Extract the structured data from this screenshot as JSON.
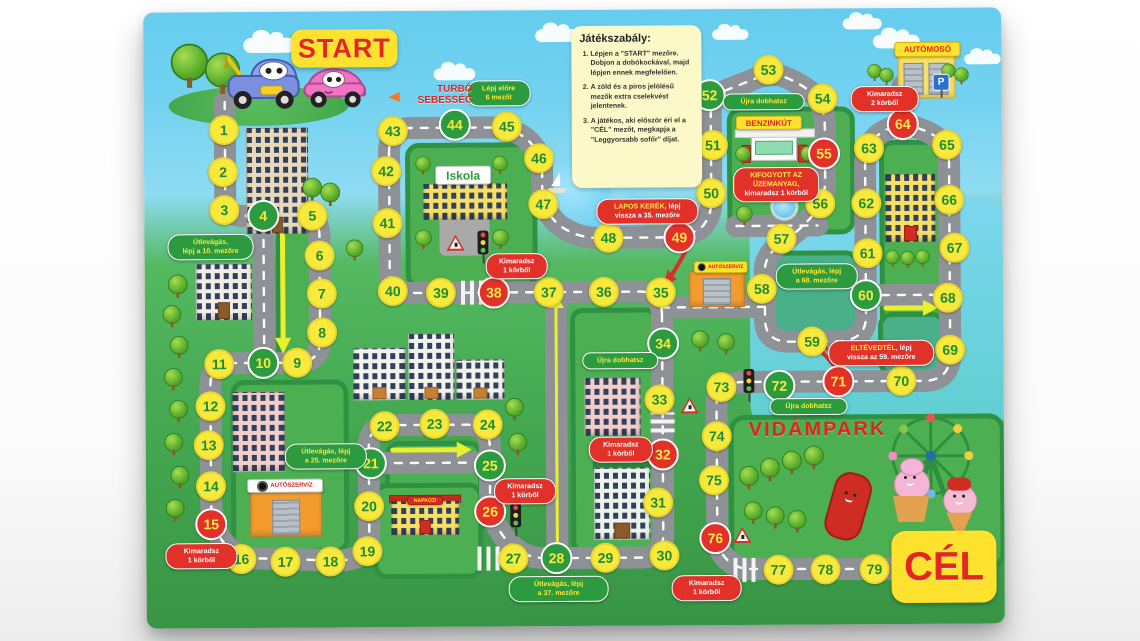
{
  "board": {
    "labels": {
      "start": "START",
      "goal": "CÉL",
      "turbo": "TURBÓ SEBESSÉG",
      "park": "VIDÁMPARK"
    },
    "rules": {
      "title": "Játékszabály:",
      "items": [
        "Lépjen a \"START\" mezőre. Dobjon a dobókockával, majd lépjen ennek megfelelően.",
        "A zöld és a piros jelölésű mezők extra cselekvést jelentenek.",
        "A játékos, aki először éri el a \"CÉL\" mezőt, megkapja a \"Leggyorsabb sofőr\" díjat."
      ]
    },
    "signs": {
      "school": "Iskola",
      "daycare": "NAPKÖZI",
      "car_service": "AUTÓSZERVIZ",
      "gas_station": "BENZINKÚT",
      "car_wash": "AUTÓMOSÓ",
      "parking": "P"
    },
    "colors": {
      "space_yellow": "#f8e93c",
      "space_green": "#2c9a3f",
      "space_red": "#e23128",
      "road": "#8e9196",
      "sign_yellow": "#ffe22e",
      "accent_red": "#e3261f"
    },
    "spaces": [
      [
        1,
        225,
        128,
        0
      ],
      [
        2,
        224,
        170,
        0
      ],
      [
        3,
        225,
        208,
        0
      ],
      [
        4,
        264,
        214,
        1
      ],
      [
        5,
        313,
        214,
        0
      ],
      [
        6,
        320,
        254,
        0
      ],
      [
        7,
        322,
        292,
        0
      ],
      [
        8,
        322,
        331,
        0
      ],
      [
        9,
        297,
        361,
        0
      ],
      [
        10,
        263,
        361,
        1
      ],
      [
        11,
        219,
        362,
        0
      ],
      [
        12,
        210,
        404,
        0
      ],
      [
        13,
        208,
        443,
        0
      ],
      [
        14,
        210,
        484,
        0
      ],
      [
        15,
        210,
        522,
        2
      ],
      [
        16,
        240,
        557,
        0
      ],
      [
        17,
        284,
        560,
        0
      ],
      [
        18,
        329,
        560,
        0
      ],
      [
        19,
        366,
        550,
        0
      ],
      [
        20,
        368,
        505,
        0
      ],
      [
        21,
        370,
        462,
        1
      ],
      [
        22,
        384,
        425,
        0
      ],
      [
        23,
        434,
        423,
        0
      ],
      [
        24,
        487,
        424,
        0
      ],
      [
        25,
        489,
        465,
        1
      ],
      [
        26,
        489,
        511,
        2
      ],
      [
        27,
        512,
        558,
        0
      ],
      [
        28,
        555,
        558,
        1
      ],
      [
        29,
        604,
        558,
        0
      ],
      [
        30,
        663,
        556,
        0
      ],
      [
        31,
        657,
        503,
        0
      ],
      [
        32,
        662,
        455,
        2
      ],
      [
        33,
        659,
        400,
        0
      ],
      [
        34,
        663,
        344,
        1
      ],
      [
        35,
        661,
        293,
        0
      ],
      [
        36,
        604,
        292,
        0
      ],
      [
        37,
        549,
        292,
        0
      ],
      [
        38,
        494,
        292,
        2
      ],
      [
        39,
        441,
        292,
        0
      ],
      [
        40,
        393,
        290,
        0
      ],
      [
        41,
        388,
        222,
        0
      ],
      [
        42,
        387,
        170,
        0
      ],
      [
        43,
        394,
        130,
        0
      ],
      [
        44,
        456,
        124,
        1
      ],
      [
        45,
        508,
        126,
        0
      ],
      [
        46,
        540,
        158,
        0
      ],
      [
        47,
        544,
        204,
        0
      ],
      [
        48,
        609,
        238,
        0
      ],
      [
        49,
        680,
        238,
        2
      ],
      [
        50,
        712,
        194,
        0
      ],
      [
        51,
        714,
        146,
        0
      ],
      [
        52,
        711,
        96,
        1
      ],
      [
        53,
        770,
        71,
        0
      ],
      [
        54,
        824,
        100,
        0
      ],
      [
        55,
        825,
        155,
        2
      ],
      [
        56,
        821,
        205,
        0
      ],
      [
        57,
        782,
        240,
        0
      ],
      [
        58,
        762,
        290,
        0
      ],
      [
        59,
        812,
        343,
        0
      ],
      [
        60,
        866,
        297,
        1
      ],
      [
        61,
        868,
        255,
        0
      ],
      [
        62,
        867,
        205,
        0
      ],
      [
        63,
        870,
        150,
        0
      ],
      [
        64,
        904,
        126,
        2
      ],
      [
        65,
        948,
        147,
        0
      ],
      [
        66,
        950,
        202,
        0
      ],
      [
        67,
        955,
        250,
        0
      ],
      [
        68,
        948,
        300,
        0
      ],
      [
        69,
        950,
        352,
        0
      ],
      [
        70,
        901,
        383,
        0
      ],
      [
        71,
        838,
        383,
        2
      ],
      [
        72,
        779,
        387,
        1
      ],
      [
        73,
        721,
        388,
        0
      ],
      [
        74,
        716,
        437,
        0
      ],
      [
        75,
        713,
        481,
        0
      ],
      [
        76,
        714,
        539,
        2
      ],
      [
        77,
        777,
        571,
        0
      ],
      [
        78,
        824,
        571,
        0
      ],
      [
        79,
        873,
        571,
        0
      ]
    ],
    "bubbles": [
      {
        "kind": "green",
        "x": 500,
        "y": 93,
        "w": 64,
        "lines": [
          [
            [
              "Lépj előre",
              0
            ]
          ],
          [
            [
              "6 mezőt",
              0
            ]
          ]
        ]
      },
      {
        "kind": "green",
        "x": 765,
        "y": 103,
        "w": 82,
        "lines": [
          [
            [
              "Újra dobhatsz",
              0
            ]
          ]
        ]
      },
      {
        "kind": "red",
        "x": 886,
        "y": 101,
        "w": 68,
        "lines": [
          [
            [
              "Kimaradsz",
              0
            ]
          ],
          [
            [
              "2 körből",
              0
            ]
          ]
        ]
      },
      {
        "kind": "red",
        "x": 777,
        "y": 186,
        "w": 86,
        "lines": [
          [
            [
              "KIFOGYOTT AZ",
              1
            ]
          ],
          [
            [
              "ÜZEMANYAG,",
              1
            ]
          ],
          [
            [
              "kimaradsz 1 körből",
              0
            ]
          ]
        ]
      },
      {
        "kind": "red",
        "x": 648,
        "y": 212,
        "w": 102,
        "lines": [
          [
            [
              "LAPOS KERÉK",
              1
            ],
            [
              ", lépj",
              0
            ]
          ],
          [
            [
              "vissza a 35. mezőre",
              0
            ]
          ]
        ]
      },
      {
        "kind": "green",
        "x": 211,
        "y": 245,
        "w": 86,
        "lines": [
          [
            [
              "Útlevágás,",
              0
            ]
          ],
          [
            [
              "lépj a 10. mezőre",
              0
            ]
          ]
        ]
      },
      {
        "kind": "red",
        "x": 517,
        "y": 266,
        "w": 62,
        "lines": [
          [
            [
              "Kimaradsz",
              0
            ]
          ],
          [
            [
              "1 körből",
              0
            ]
          ]
        ]
      },
      {
        "kind": "green",
        "x": 817,
        "y": 278,
        "w": 82,
        "lines": [
          [
            [
              "Útlevágás, lépj",
              0
            ]
          ],
          [
            [
              "a 68. mezőre",
              0
            ]
          ]
        ]
      },
      {
        "kind": "red",
        "x": 881,
        "y": 355,
        "w": 106,
        "lines": [
          [
            [
              "ELTÉVEDTÉL",
              1
            ],
            [
              ", lépj",
              0
            ]
          ],
          [
            [
              "vissza az 59. mezőre",
              0
            ]
          ]
        ]
      },
      {
        "kind": "green",
        "x": 620,
        "y": 361,
        "w": 76,
        "lines": [
          [
            [
              "Újra dobhatsz",
              0
            ]
          ]
        ]
      },
      {
        "kind": "green",
        "x": 808,
        "y": 408,
        "w": 78,
        "lines": [
          [
            [
              "Újra dobhatsz",
              0
            ]
          ]
        ]
      },
      {
        "kind": "red",
        "x": 620,
        "y": 450,
        "w": 64,
        "lines": [
          [
            [
              "Kimaradsz",
              0
            ]
          ],
          [
            [
              "1 körből",
              0
            ]
          ]
        ]
      },
      {
        "kind": "green",
        "x": 325,
        "y": 455,
        "w": 82,
        "lines": [
          [
            [
              "Útlevágás, lépj",
              0
            ]
          ],
          [
            [
              "a 25. mezőre",
              0
            ]
          ]
        ]
      },
      {
        "kind": "red",
        "x": 200,
        "y": 554,
        "w": 72,
        "lines": [
          [
            [
              "Kimaradsz",
              0
            ]
          ],
          [
            [
              "1 körből",
              0
            ]
          ]
        ]
      },
      {
        "kind": "red",
        "x": 524,
        "y": 491,
        "w": 62,
        "lines": [
          [
            [
              "Kimaradsz",
              0
            ]
          ],
          [
            [
              "1 körből",
              0
            ]
          ]
        ]
      },
      {
        "kind": "green",
        "x": 557,
        "y": 589,
        "w": 100,
        "lines": [
          [
            [
              "Útlevágás, lépj",
              0
            ]
          ],
          [
            [
              "a 37. mezőre",
              0
            ]
          ]
        ]
      },
      {
        "kind": "red",
        "x": 705,
        "y": 589,
        "w": 70,
        "lines": [
          [
            [
              "Kimaradsz",
              0
            ]
          ],
          [
            [
              "1 körből",
              0
            ]
          ]
        ]
      }
    ]
  }
}
